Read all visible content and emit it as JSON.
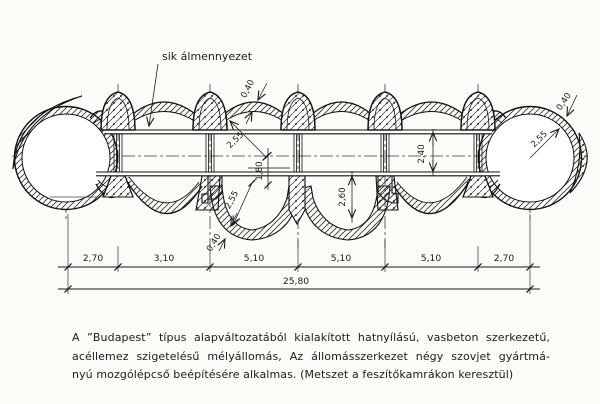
{
  "labels": {
    "false_ceiling": "sik álmennyezet"
  },
  "dims": {
    "roof_lining_thickness": "0,40",
    "tube_inner_radius": "2,55",
    "axis_to_platform": "1,80",
    "hall_clear_height": "2,40",
    "right_tube_radius": "2,55",
    "right_lining_thickness": "0,40",
    "chamber_depth": "2,60",
    "trough_inner_radius": "2,55",
    "trough_lining_thickness": "0,40"
  },
  "dimension_chain": {
    "segments": [
      "2,70",
      "3,10",
      "5,10",
      "5,10",
      "5,10",
      "2,70"
    ],
    "total": "25,80"
  },
  "caption": {
    "lines": [
      "A ”Budapest” típus alapváltozatából kialakított hatnyílású, vasbeton szerkezetű,",
      "acéllemez szigetelésű mélyállomás, Az állomásszerkezet négy szovjet gyártmá-",
      "nyú mozgólépcső beépítésére alkalmas. (Metszet a feszítőkamrákon keresztül)"
    ]
  }
}
